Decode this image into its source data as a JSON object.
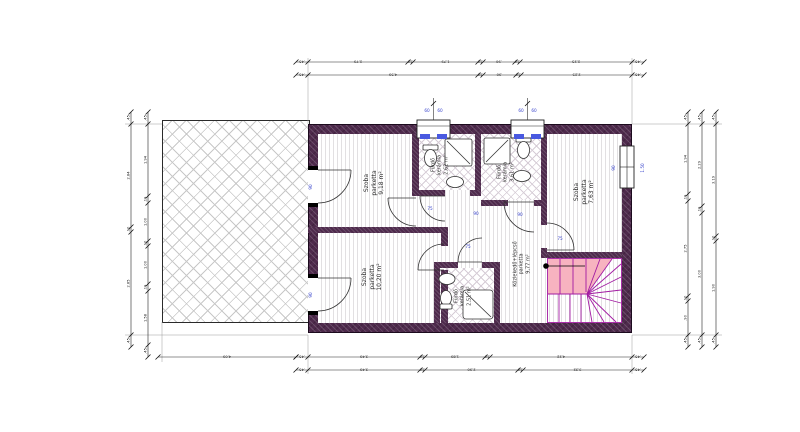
{
  "drawing": {
    "type": "floor-plan",
    "language": "Hungarian",
    "colors": {
      "wall": "#4e2a4c",
      "stair_fill": "#f7b3c0",
      "stair_line": "#a21ba2",
      "dim_blue": "#3a45cc",
      "dim_black": "#222222",
      "hatch_gray": "#c8c8c8"
    }
  },
  "rooms": [
    {
      "name": "Szoba",
      "floor": "parketta",
      "area": "9,18 m²"
    },
    {
      "name": "Szoba",
      "floor": "parketta",
      "area": "10,20 m²"
    },
    {
      "name": "Fürdő",
      "floor": "kerámia",
      "area": "2,62 m²"
    },
    {
      "name": "Fürdő",
      "floor": "kerámia",
      "area": "3,61 m²"
    },
    {
      "name": "Fürdő",
      "floor": "kerámia",
      "area": "2,51 m²"
    },
    {
      "name": "Szoba",
      "floor": "parketta",
      "area": "7,63 m²"
    },
    {
      "name": "Közlekedő+lépcső",
      "floor": "parketta",
      "area": "9,77 m²"
    }
  ],
  "chains": [
    {
      "o": "h",
      "x": 296,
      "y": 62,
      "weights": [
        12,
        100,
        5,
        65,
        5,
        32,
        5,
        112,
        12
      ],
      "labels": [
        ".45",
        "2.79",
        ".10",
        "1.79",
        ".10",
        ".90",
        ".10",
        "2.25",
        ".45"
      ]
    },
    {
      "o": "h",
      "x": 296,
      "y": 75,
      "weights": [
        12,
        170,
        5,
        33,
        5,
        111,
        12
      ],
      "labels": [
        ".45",
        "4.59",
        ".10",
        ".90",
        ".10",
        "2.25",
        ".45"
      ]
    },
    {
      "o": "h",
      "x": 296,
      "y": 357,
      "weights": [
        12,
        112,
        5,
        60,
        5,
        142,
        12
      ],
      "labels": [
        ".45",
        "3.49",
        ".10",
        "1.89",
        ".10",
        "4.22",
        ".45"
      ]
    },
    {
      "o": "h",
      "x": 296,
      "y": 370,
      "weights": [
        12,
        112,
        5,
        93,
        5,
        109,
        12
      ],
      "labels": [
        ".45",
        "3.49",
        ".10",
        "2.90",
        ".10",
        "3.32",
        ".45"
      ]
    },
    {
      "o": "h",
      "x": 158,
      "y": 357,
      "weights": [
        138
      ],
      "labels": [
        "4.09"
      ]
    },
    {
      "o": "v",
      "x": 131,
      "y": 112,
      "weights": [
        12,
        103,
        5,
        103,
        12
      ],
      "labels": [
        ".45",
        "2.84",
        ".10",
        "2.85",
        ".45"
      ]
    },
    {
      "o": "v",
      "x": 148,
      "y": 112,
      "weights": [
        12,
        72,
        7,
        38,
        5,
        38,
        7,
        54,
        12
      ],
      "labels": [
        ".45",
        "1.94",
        ".19",
        "1.00",
        ".10",
        "1.00",
        ".19",
        "1.58",
        ".45"
      ]
    },
    {
      "o": "v",
      "x": 688,
      "y": 112,
      "weights": [
        12,
        70,
        7,
        95,
        5,
        34,
        12
      ],
      "labels": [
        ".45",
        "1.94",
        ".19",
        "2.75",
        ".10",
        ".90",
        ".45"
      ]
    },
    {
      "o": "v",
      "x": 702,
      "y": 112,
      "weights": [
        12,
        82,
        7,
        122,
        12
      ],
      "labels": [
        ".45",
        "2.29",
        ".19",
        "3.00",
        ".45"
      ]
    },
    {
      "o": "v",
      "x": 716,
      "y": 112,
      "weights": [
        12,
        112,
        5,
        94,
        12
      ],
      "labels": [
        ".45",
        "3.19",
        ".10",
        "1.90",
        ".45"
      ]
    }
  ],
  "blue_labels": [
    {
      "text": "90",
      "x": 312,
      "y": 187,
      "rot": -90
    },
    {
      "text": "90",
      "x": 312,
      "y": 295,
      "rot": -90
    },
    {
      "text": "75",
      "x": 430,
      "y": 210,
      "rot": 0
    },
    {
      "text": "90",
      "x": 476,
      "y": 215,
      "rot": 0
    },
    {
      "text": "90",
      "x": 520,
      "y": 216,
      "rot": 0
    },
    {
      "text": "75",
      "x": 560,
      "y": 240,
      "rot": 0
    },
    {
      "text": "75",
      "x": 468,
      "y": 248,
      "rot": 0
    },
    {
      "text": "60",
      "x": 427,
      "y": 112,
      "rot": 0
    },
    {
      "text": "60",
      "x": 440,
      "y": 112,
      "rot": 0
    },
    {
      "text": "60",
      "x": 521,
      "y": 112,
      "rot": 0
    },
    {
      "text": "60",
      "x": 534,
      "y": 112,
      "rot": 0
    },
    {
      "text": "90",
      "x": 615,
      "y": 168,
      "rot": -90
    },
    {
      "text": "1.50",
      "x": 644,
      "y": 168,
      "rot": -90
    }
  ]
}
